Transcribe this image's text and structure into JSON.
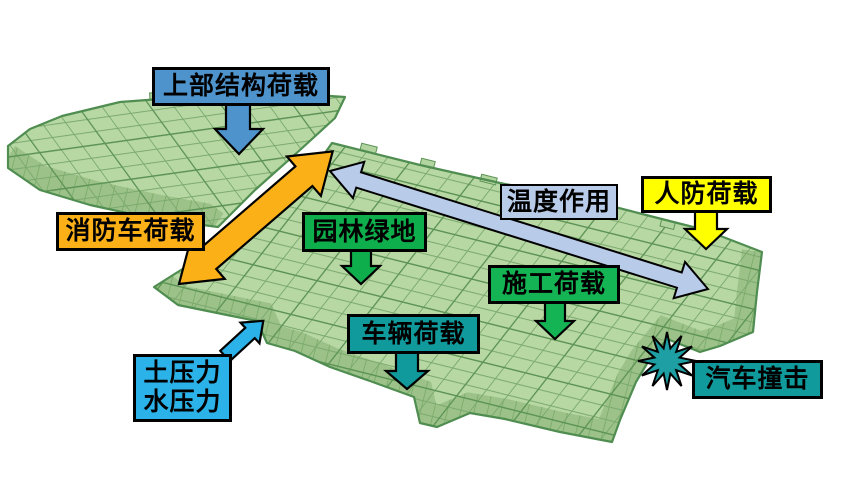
{
  "canvas": {
    "width": 841,
    "height": 495,
    "background": "#ffffff"
  },
  "model": {
    "name": "green-wireframe-structure-model",
    "description": "translucent green 3D wireframe slab model (two wings) that all load annotations point to",
    "surface_color": "#b7d7a3",
    "grid_line_color": "#7aa96d",
    "edge_color": "#4f8d50"
  },
  "boxes": {
    "upper": {
      "label": "上部结构荷载",
      "color": "#4e93cb"
    },
    "fire": {
      "label": "消防车荷载",
      "color": "#fbb018"
    },
    "temperature": {
      "label": "温度作用",
      "color": "#b8cbe8"
    },
    "civil": {
      "label": "人防荷载",
      "color": "#ffff00"
    },
    "garden": {
      "label": "园林绿地",
      "color": "#0fae4d"
    },
    "construction": {
      "label": "施工荷载",
      "color": "#14b455"
    },
    "vehicle": {
      "label": "车辆荷载",
      "color": "#119a9c"
    },
    "earth_water": {
      "line1": "土压力",
      "line2": "水压力",
      "color": "#2ab2e9"
    },
    "impact": {
      "label": "汽车撞击",
      "color": "#119a9c"
    }
  },
  "arrows": {
    "upper_structure": {
      "type": "down-arrow",
      "color": "#4e93cb"
    },
    "fire_truck": {
      "type": "double-head-diagonal",
      "color": "#fbb018"
    },
    "temperature": {
      "type": "double-head-long",
      "color": "#b8cbe8"
    },
    "civil_defense": {
      "type": "down-arrow",
      "color": "#ffff00"
    },
    "garden": {
      "type": "down-arrow",
      "color": "#0fae4d"
    },
    "construction": {
      "type": "down-arrow",
      "color": "#14b455"
    },
    "vehicle": {
      "type": "down-arrow",
      "color": "#119a9c"
    },
    "earth_water": {
      "type": "up-right-arrow",
      "color": "#2ab2e9"
    },
    "impact": {
      "type": "starburst",
      "color": "#1d9fa3"
    }
  }
}
